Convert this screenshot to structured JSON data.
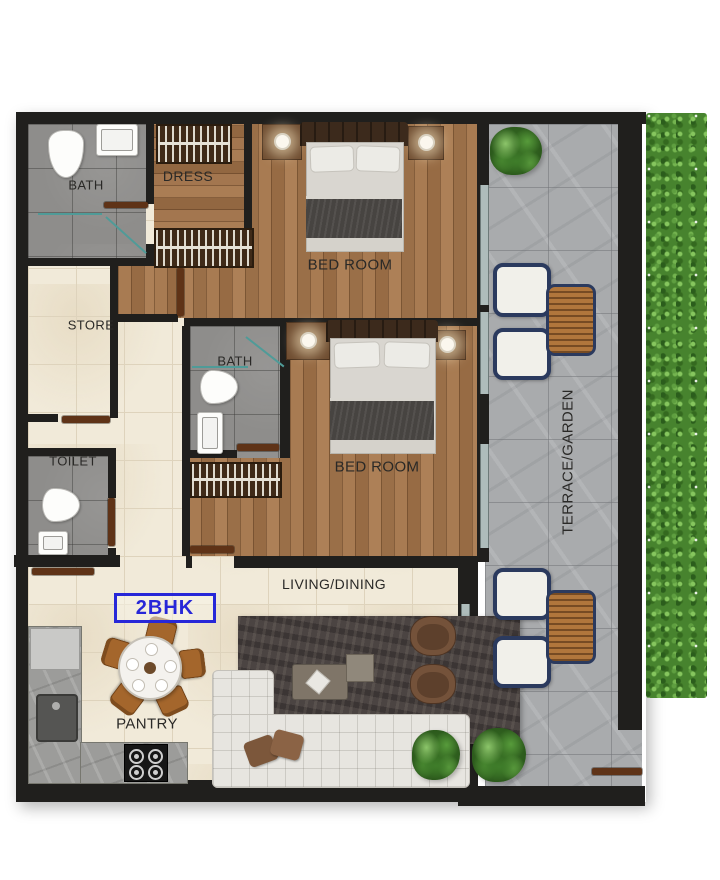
{
  "unit_badge": {
    "label": "2BHK",
    "accent_color": "#2727d8"
  },
  "rooms": {
    "bath_top": "BATH",
    "dress": "DRESS",
    "bedroom_top": "BED ROOM",
    "store": "STORE",
    "bath_middle": "BATH",
    "toilet": "TOILET",
    "bedroom_middle": "BED ROOM",
    "living_dining": "LIVING/DINING",
    "pantry": "PANTRY",
    "terrace": "TERRACE/GARDEN"
  },
  "colors": {
    "wall": "#201f1d",
    "wood_floor": "#a3774e",
    "bath_tile": "#8e8d8b",
    "cream_tile": "#f1ead9",
    "terrace_stone": "#a9abad",
    "hedge_green": "#47832e",
    "glass_partition": "#4f9b98",
    "door_wood": "#5f3317",
    "accent_blue": "#2727d8"
  }
}
